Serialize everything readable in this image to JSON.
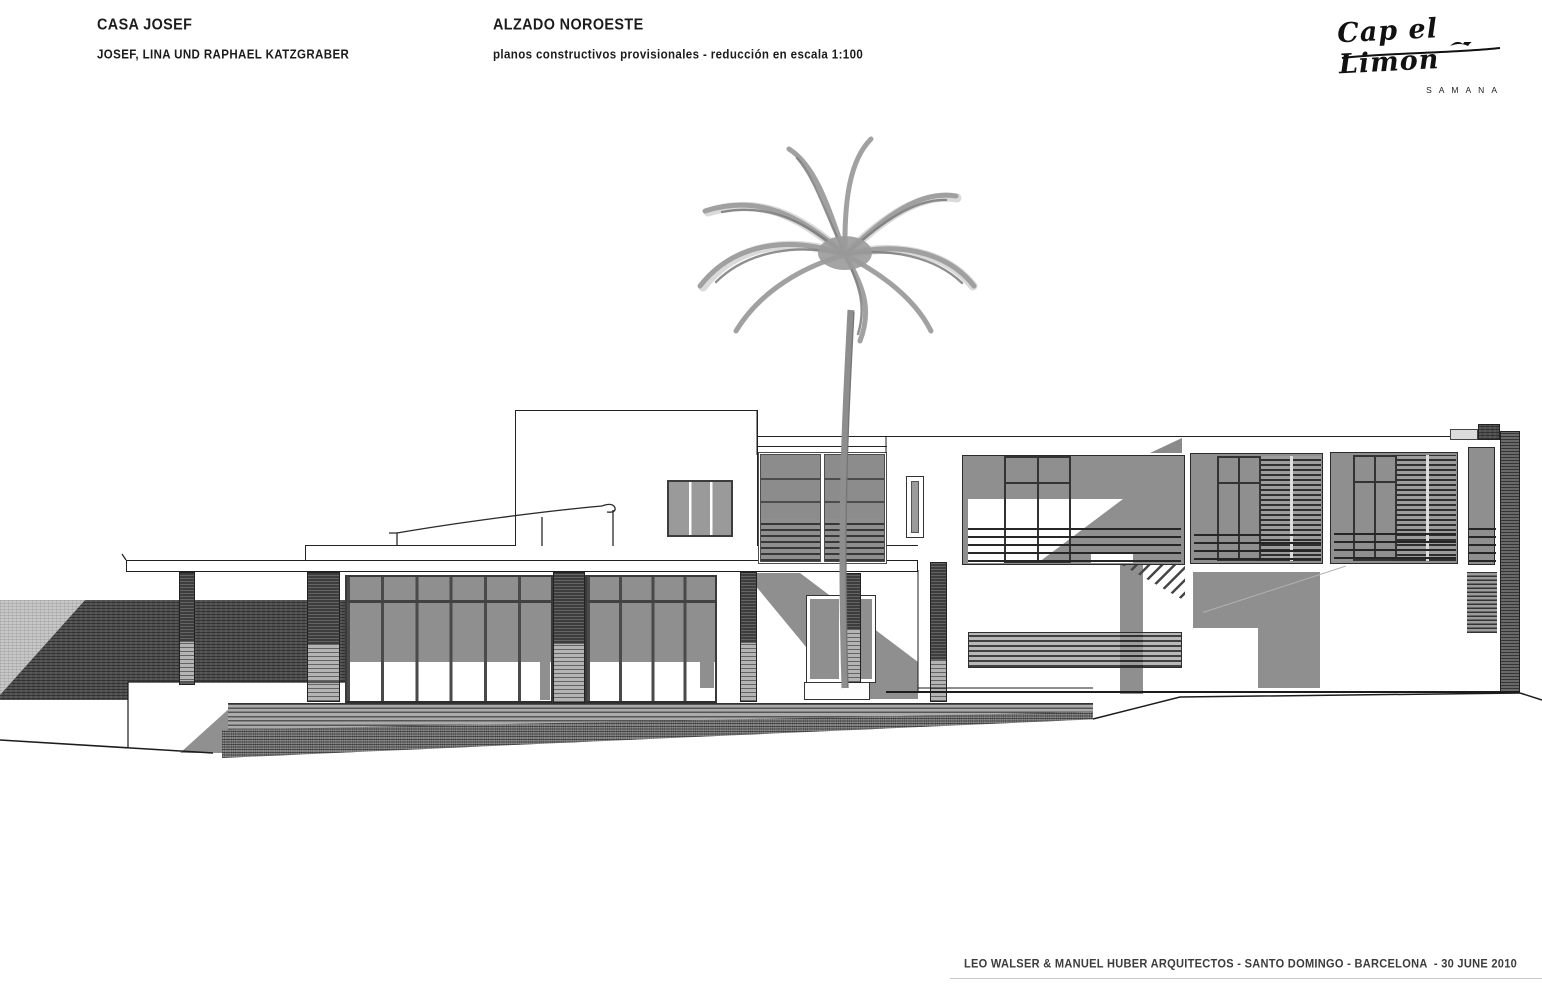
{
  "header": {
    "project_title": "CASA JOSEF",
    "project_subtitle": "JOSEF, LINA UND RAPHAEL KATZGRABER",
    "drawing_title": "ALZADO NOROESTE",
    "drawing_subtitle": "planos constructivos provisionales - reducción en escala 1:100"
  },
  "logo": {
    "name": "Cap el Limon",
    "subtext": "SAMANA"
  },
  "footer": {
    "credit": "LEO WALSER & MANUEL HUBER ARQUITECTOS - SANTO DOMINGO - BARCELONA  - 30 JUNE 2010"
  },
  "drawing": {
    "subject": "northwest-elevation-of-villa-with-palm-tree",
    "scale": "1:100",
    "colors": {
      "paper": "#ffffff",
      "linework": "#1c1c1c",
      "glass_grey": "#8f8f8f",
      "shadow_grey": "#8f8f8f",
      "dark_stone": "#4f4f4f",
      "light_stone": "#b4b4b4",
      "terrace_grey": "#ababab",
      "palm_grey": "#9d9d9d"
    }
  }
}
